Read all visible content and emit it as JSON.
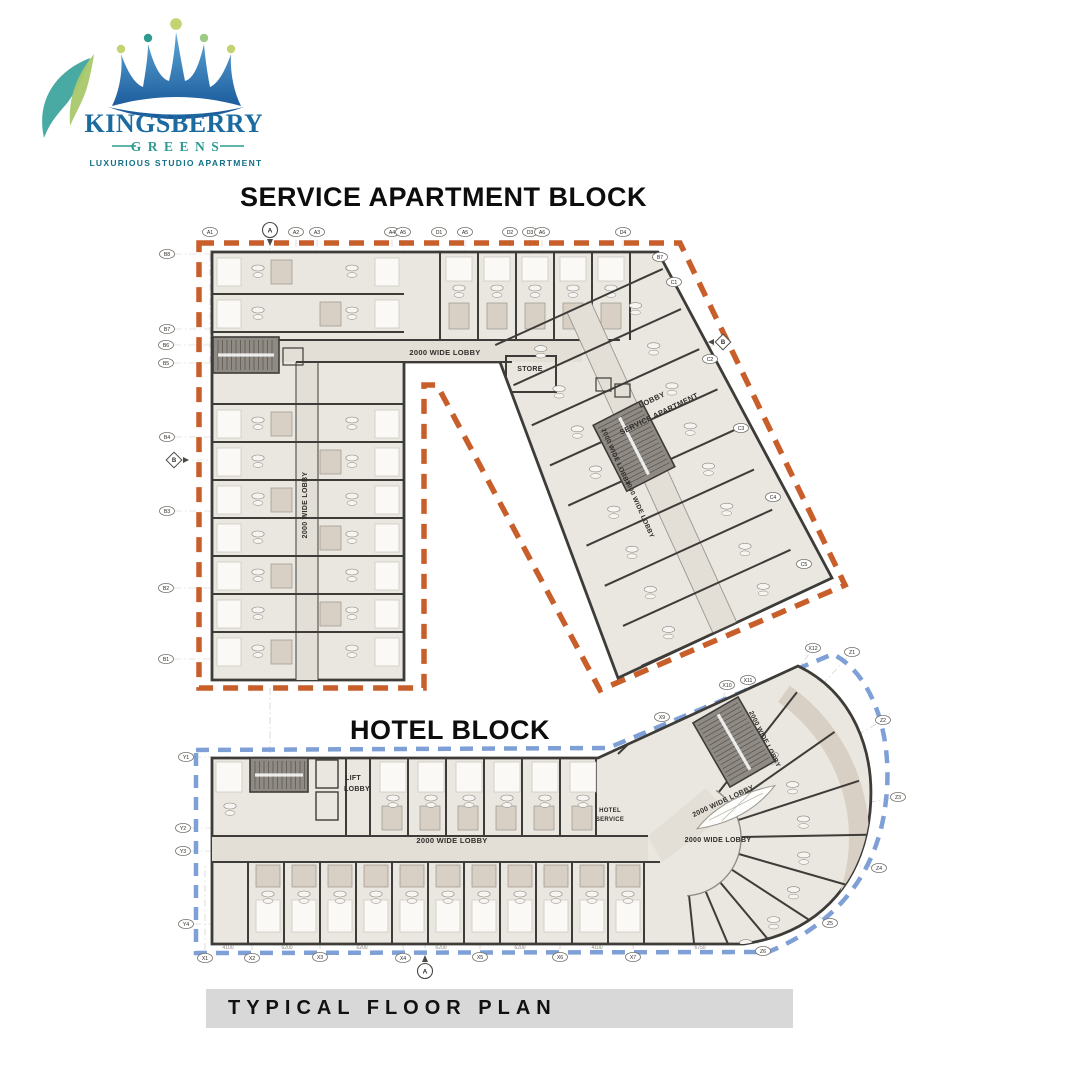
{
  "logo": {
    "brand": "KINGSBERRY",
    "brand2": "GREENS",
    "tagline": "LUXURIOUS STUDIO APARTMENT"
  },
  "titles": {
    "service": "SERVICE APARTMENT BLOCK",
    "hotel": "HOTEL BLOCK"
  },
  "caption": "TYPICAL FLOOR PLAN",
  "colors": {
    "orange_boundary": "#C85F2B",
    "blue_boundary": "#7FA0D6",
    "wall": "#3E3C39",
    "fill": "#EAE7E0",
    "fill2": "#D8D0C4",
    "corridor": "#E3DFD6",
    "stair": "#8F8A84",
    "stair_step": "#55514C",
    "white_room": "#FAF9F6",
    "banner": "#D8D8D8",
    "logo_blue": "#1C6BA0",
    "logo_teal": "#2E9B8F",
    "logo_dark_teal": "#136F86",
    "leaf_green": "#A9C86B",
    "ball_green": "#C2D36F",
    "centerline": "#CCC9C2",
    "dim_text": "#8A867F"
  },
  "service_block": {
    "labels": [
      {
        "t": "2000 WIDE LOBBY",
        "x": 445,
        "y": 355,
        "r": 0,
        "s": 7.5
      },
      {
        "t": "2000 WIDE LOBBY",
        "x": 307,
        "y": 505,
        "r": -90,
        "s": 7
      },
      {
        "t": "STORE",
        "x": 530,
        "y": 371,
        "r": 0,
        "s": 7
      },
      {
        "t": "2000 WIDE LOBBY",
        "x": 614,
        "y": 458,
        "r": 66,
        "s": 6.5
      },
      {
        "t": "2000 WIDE LOBBY",
        "x": 638,
        "y": 510,
        "r": 66,
        "s": 6.5
      },
      {
        "t": "LOBBY",
        "x": 653,
        "y": 402,
        "r": -26,
        "s": 7.5
      },
      {
        "t": "SERVICE APARTMENT",
        "x": 660,
        "y": 416,
        "r": -26,
        "s": 7.5
      }
    ],
    "markers": [
      {
        "l": "A1",
        "x": 210,
        "y": 232,
        "s": "top"
      },
      {
        "l": "A",
        "x": 270,
        "y": 230,
        "s": "top",
        "shape": "circle"
      },
      {
        "l": "A2",
        "x": 296,
        "y": 232,
        "s": "top"
      },
      {
        "l": "A3",
        "x": 317,
        "y": 232,
        "s": "top"
      },
      {
        "l": "A4",
        "x": 392,
        "y": 232,
        "s": "top"
      },
      {
        "l": "A5",
        "x": 403,
        "y": 232,
        "s": "top"
      },
      {
        "l": "D1",
        "x": 439,
        "y": 232,
        "s": "top"
      },
      {
        "l": "A5",
        "x": 465,
        "y": 232,
        "s": "top"
      },
      {
        "l": "D2",
        "x": 510,
        "y": 232,
        "s": "top"
      },
      {
        "l": "D3",
        "x": 530,
        "y": 232,
        "s": "top"
      },
      {
        "l": "A6",
        "x": 542,
        "y": 232,
        "s": "top"
      },
      {
        "l": "D4",
        "x": 623,
        "y": 232,
        "s": "top"
      },
      {
        "l": "B8",
        "x": 167,
        "y": 254,
        "s": "left"
      },
      {
        "l": "B7",
        "x": 167,
        "y": 329,
        "s": "left"
      },
      {
        "l": "B6",
        "x": 166,
        "y": 345,
        "s": "left"
      },
      {
        "l": "B5",
        "x": 166,
        "y": 363,
        "s": "left"
      },
      {
        "l": "B4",
        "x": 167,
        "y": 437,
        "s": "left"
      },
      {
        "l": "B",
        "x": 174,
        "y": 460,
        "s": "left",
        "shape": "diamond"
      },
      {
        "l": "B3",
        "x": 167,
        "y": 511,
        "s": "left"
      },
      {
        "l": "B2",
        "x": 166,
        "y": 588,
        "s": "left"
      },
      {
        "l": "B1",
        "x": 166,
        "y": 659,
        "s": "left"
      },
      {
        "l": "B7",
        "x": 660,
        "y": 257,
        "s": "right"
      },
      {
        "l": "C1",
        "x": 674,
        "y": 282,
        "s": "right"
      },
      {
        "l": "B",
        "x": 723,
        "y": 342,
        "s": "right",
        "shape": "diamond"
      },
      {
        "l": "C2",
        "x": 710,
        "y": 359,
        "s": "right"
      },
      {
        "l": "C3",
        "x": 741,
        "y": 428,
        "s": "right"
      },
      {
        "l": "C4",
        "x": 773,
        "y": 497,
        "s": "right"
      },
      {
        "l": "C5",
        "x": 804,
        "y": 564,
        "s": "right"
      }
    ]
  },
  "hotel_block": {
    "labels": [
      {
        "t": "LIFT",
        "x": 353,
        "y": 780,
        "r": 0,
        "s": 7
      },
      {
        "t": "LOBBY",
        "x": 357,
        "y": 791,
        "r": 0,
        "s": 7
      },
      {
        "t": "2000 WIDE LOBBY",
        "x": 452,
        "y": 843,
        "r": 0,
        "s": 7.5
      },
      {
        "t": "HOTEL",
        "x": 610,
        "y": 812,
        "r": 0,
        "s": 6
      },
      {
        "t": "SERVICE",
        "x": 610,
        "y": 821,
        "r": 0,
        "s": 6
      },
      {
        "t": "2000 WIDE LOBBY",
        "x": 718,
        "y": 842,
        "r": 0,
        "s": 7
      },
      {
        "t": "2000 WIDE LOBBY",
        "x": 763,
        "y": 740,
        "r": 63,
        "s": 6.5
      },
      {
        "t": "2000 WIDE LOBBY",
        "x": 724,
        "y": 803,
        "r": -25,
        "s": 7
      }
    ],
    "markers": [
      {
        "l": "Y1",
        "x": 186,
        "y": 757,
        "s": "hleft"
      },
      {
        "l": "Y2",
        "x": 183,
        "y": 828,
        "s": "hleft"
      },
      {
        "l": "Y3",
        "x": 183,
        "y": 851,
        "s": "hleft"
      },
      {
        "l": "Y4",
        "x": 186,
        "y": 924,
        "s": "hleft"
      },
      {
        "l": "X1",
        "x": 205,
        "y": 958,
        "s": "hbottom"
      },
      {
        "l": "X2",
        "x": 252,
        "y": 958,
        "s": "hbottom"
      },
      {
        "l": "X3",
        "x": 320,
        "y": 957,
        "s": "hbottom"
      },
      {
        "l": "A",
        "x": 425,
        "y": 971,
        "s": "hbottom",
        "shape": "circle"
      },
      {
        "l": "X4",
        "x": 403,
        "y": 958,
        "s": "hbottom"
      },
      {
        "l": "X5",
        "x": 480,
        "y": 957,
        "s": "hbottom"
      },
      {
        "l": "X6",
        "x": 560,
        "y": 957,
        "s": "hbottom"
      },
      {
        "l": "X7",
        "x": 633,
        "y": 957,
        "s": "hbottom"
      },
      {
        "l": "X9",
        "x": 662,
        "y": 717,
        "s": "curve"
      },
      {
        "l": "X10",
        "x": 727,
        "y": 685,
        "s": "curve"
      },
      {
        "l": "X11",
        "x": 748,
        "y": 680,
        "s": "curve"
      },
      {
        "l": "X12",
        "x": 813,
        "y": 648,
        "s": "curve"
      },
      {
        "l": "Z1",
        "x": 852,
        "y": 652,
        "s": "curve"
      },
      {
        "l": "Z2",
        "x": 883,
        "y": 720,
        "s": "curve"
      },
      {
        "l": "Z3",
        "x": 898,
        "y": 797,
        "s": "curve"
      },
      {
        "l": "Z4",
        "x": 879,
        "y": 868,
        "s": "curve"
      },
      {
        "l": "Z5",
        "x": 830,
        "y": 923,
        "s": "curve"
      },
      {
        "l": "Z6",
        "x": 763,
        "y": 951,
        "s": "curve"
      }
    ],
    "dimensions": {
      "y": 949,
      "items": [
        {
          "text": "4100",
          "x": 228
        },
        {
          "text": "6200",
          "x": 287
        },
        {
          "text": "6200",
          "x": 362
        },
        {
          "text": "6200",
          "x": 441
        },
        {
          "text": "6200",
          "x": 520
        },
        {
          "text": "4100",
          "x": 597
        },
        {
          "text": "6750",
          "x": 700
        }
      ]
    }
  }
}
